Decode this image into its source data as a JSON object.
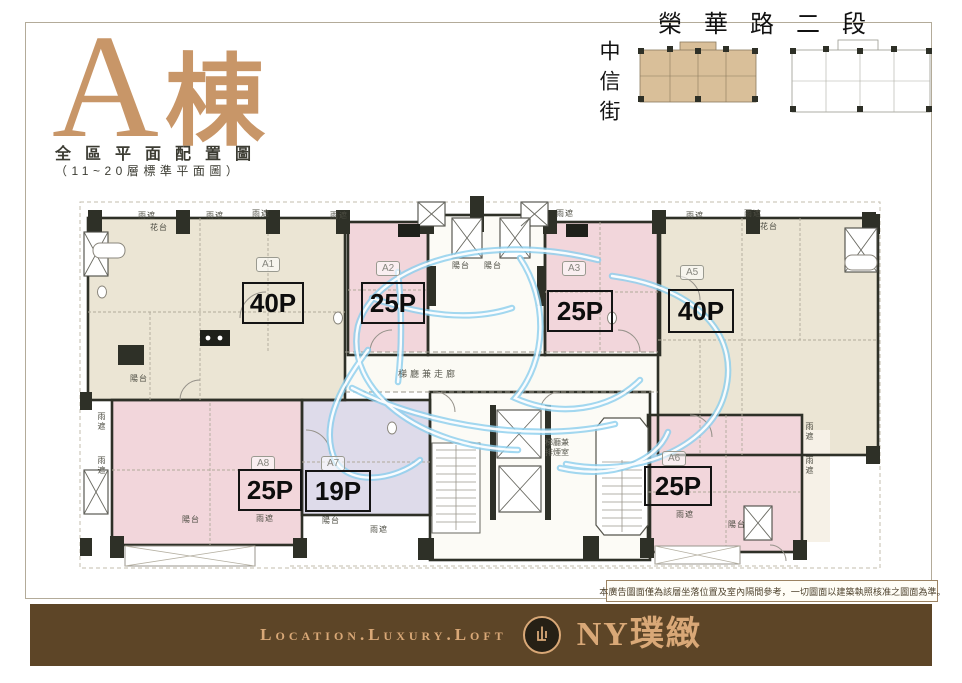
{
  "header": {
    "building_title_letter": "A",
    "building_title_suffix": "棟",
    "subtitle": "全區平面配置圖",
    "subtitle_note": "（11~20層標準平面圖）",
    "road_label": "榮華路二段",
    "street_label": "中信街"
  },
  "plan": {
    "units": [
      {
        "id": "A1",
        "size": "40P"
      },
      {
        "id": "A2",
        "size": "25P"
      },
      {
        "id": "A3",
        "size": "25P"
      },
      {
        "id": "A5",
        "size": "40P"
      },
      {
        "id": "A8",
        "size": "25P"
      },
      {
        "id": "A7",
        "size": "19P"
      },
      {
        "id": "A6",
        "size": "25P"
      }
    ],
    "corridor_label": "梯廳兼走廊",
    "smoke_room_label_line1": "梯廳兼",
    "smoke_room_label_line2": "排煙室",
    "small_labels": [
      {
        "text": "雨遮"
      },
      {
        "text": "花台"
      },
      {
        "text": "雨遮"
      },
      {
        "text": "雨遮"
      },
      {
        "text": "雨遮"
      },
      {
        "text": "雨遮"
      },
      {
        "text": "雨遮"
      },
      {
        "text": "雨遮"
      },
      {
        "text": "花台"
      },
      {
        "text": "陽台"
      },
      {
        "text": "雨遮"
      },
      {
        "text": "陽台"
      },
      {
        "text": "雨遮"
      },
      {
        "text": "雨遮"
      },
      {
        "text": "陽台"
      },
      {
        "text": "陽台"
      },
      {
        "text": "陽台"
      },
      {
        "text": "陽台"
      },
      {
        "text": "雨遮"
      },
      {
        "text": "雨遮"
      },
      {
        "text": "雨遮"
      },
      {
        "text": "雨遮"
      }
    ]
  },
  "disclaimer": "本廣告圖面僅為該層坐落位置及室內隔間參考，一切圖面以建築執照核准之圖面為準。",
  "footer": {
    "tagline": "Location.Luxury.Loft",
    "brand": "NY璞緻"
  },
  "colors": {
    "title_tan": "#c89668",
    "unit_cream": "#ebe5d4",
    "unit_pink": "#f2d6db",
    "unit_lavender": "#dedbea",
    "wall_dark": "#2e3027",
    "watermark_blue": "#8ccfee",
    "footer_brown": "#5d4527",
    "footer_text_tan": "#d9a877",
    "frame_line": "#b3ab99"
  }
}
